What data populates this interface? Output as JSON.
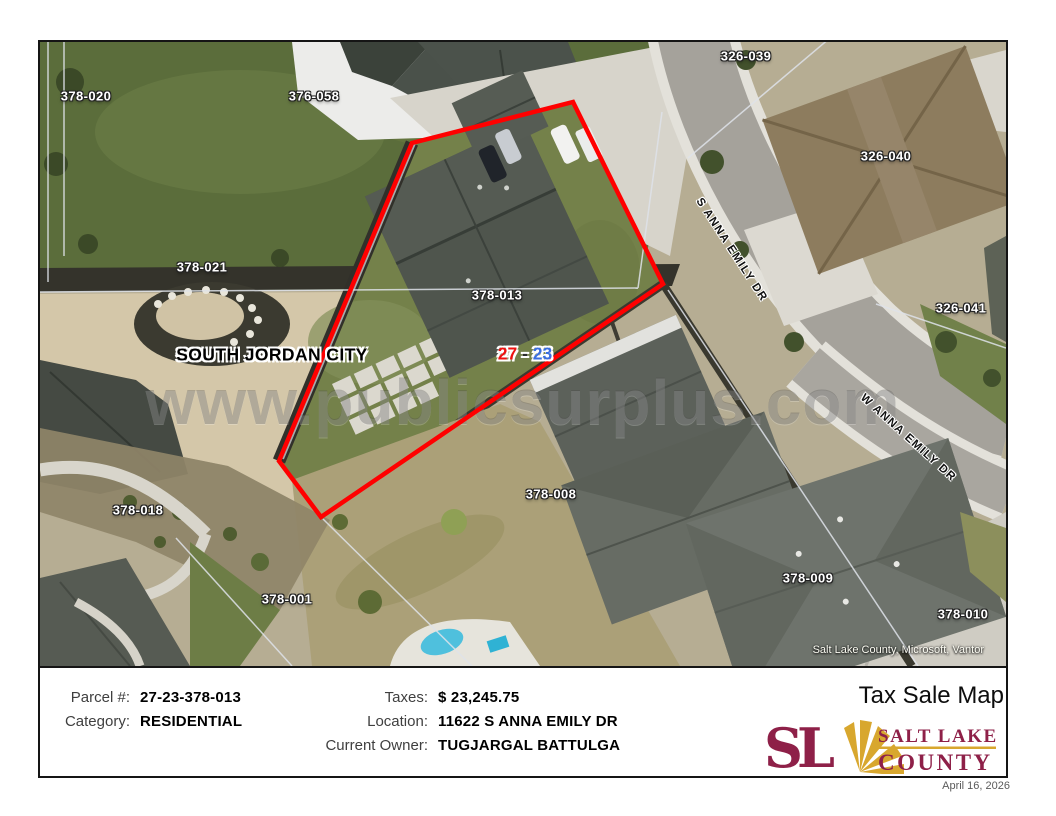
{
  "map": {
    "parcels": [
      "378-020",
      "376-058",
      "326-039",
      "326-040",
      "378-021",
      "326-041",
      "378-013",
      "378-018",
      "378-008",
      "378-001",
      "378-009",
      "378-010"
    ],
    "city_label": "SOUTH JORDAN CITY",
    "ref": {
      "left": "27",
      "dash": "-",
      "right": "23"
    },
    "streets": [
      "S ANNA EMILY DR",
      "W ANNA EMILY DR"
    ],
    "watermark": "www.publicsurplus.com",
    "attribution": "Salt Lake County, Microsoft, Vantor",
    "outline_color": "#ff0000",
    "ref_colors": {
      "left": "#ee1111",
      "right": "#3a6ee0"
    }
  },
  "footer": {
    "fields": [
      {
        "label": "Parcel #:",
        "value": "27-23-378-013"
      },
      {
        "label": "Category:",
        "value": "RESIDENTIAL"
      },
      {
        "label": "Taxes:",
        "value": "$ 23,245.75"
      },
      {
        "label": "Location:",
        "value": "11622 S ANNA EMILY DR"
      },
      {
        "label": "Current Owner:",
        "value": "TUGJARGAL BATTULGA"
      }
    ],
    "title": "Tax Sale Map",
    "logo": {
      "monogram": "SL",
      "line1": "SALT LAKE",
      "line2": "COUNTY",
      "maroon": "#8e2048",
      "gold": "#d8a72e"
    },
    "date": "April 16, 2026"
  }
}
